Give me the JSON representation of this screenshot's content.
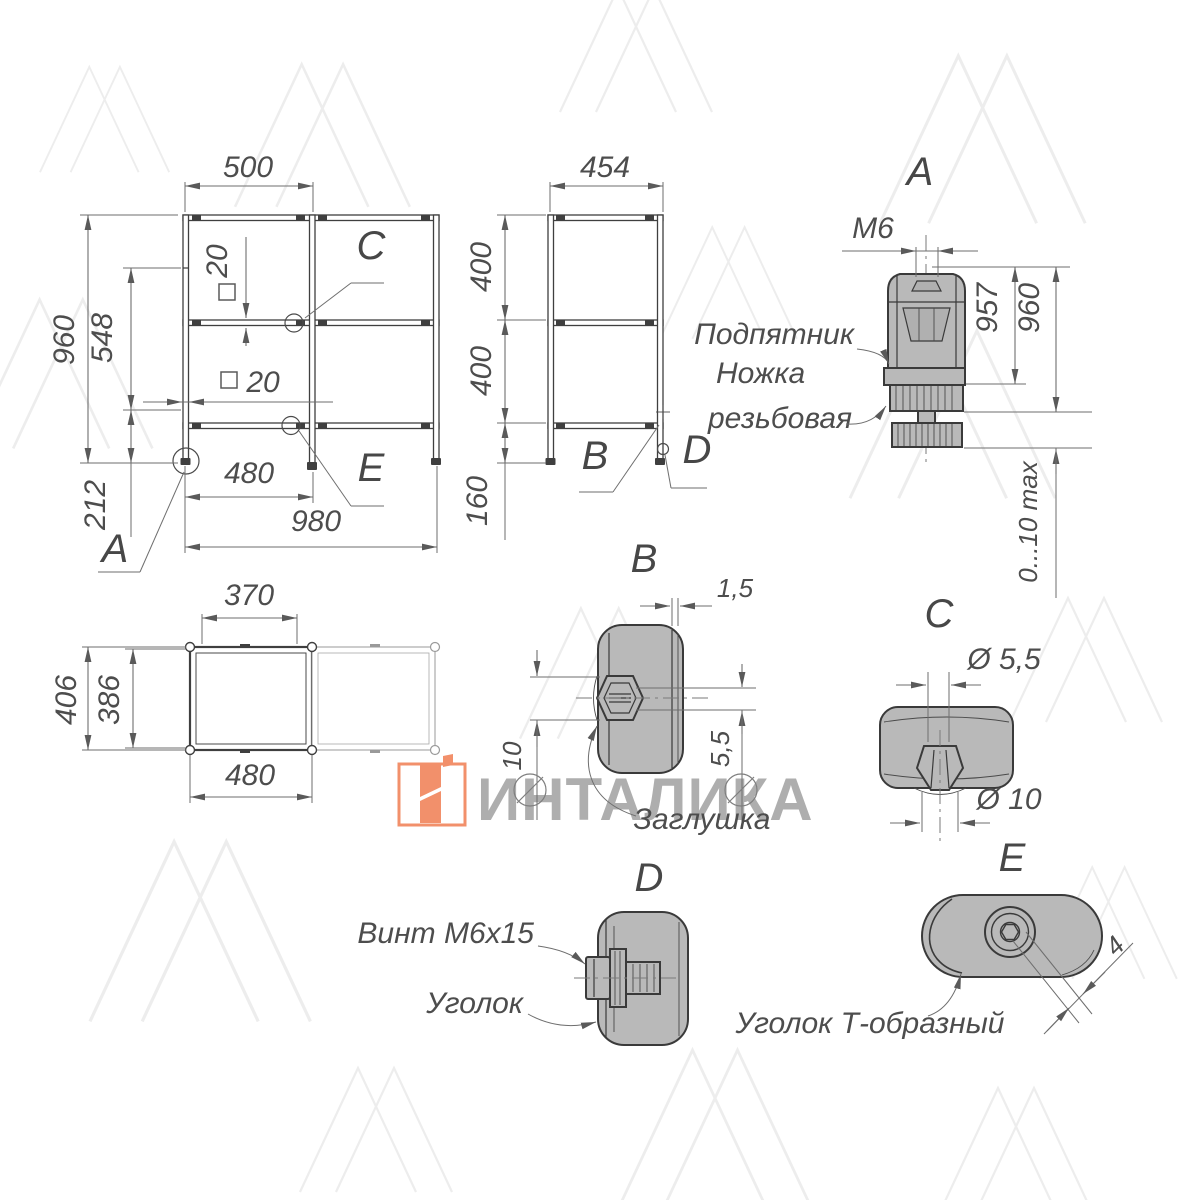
{
  "watermark": {
    "brand": "ИНТАЛИКА",
    "accent": "#F2906B",
    "text_color": "#aeaeae"
  },
  "front_view": {
    "dim_width_top": "500",
    "dim_height_total": "960",
    "dim_height_mid": "548",
    "dim_height_bottom": "212",
    "dim_tube_vertical": "20",
    "dim_tube_horizontal": "20",
    "dim_width_bay": "480",
    "dim_width_total": "980",
    "label_a": "A",
    "label_c": "C",
    "label_e": "E"
  },
  "side_view": {
    "dim_depth": "454",
    "dim_upper": "400",
    "dim_lower": "400",
    "dim_legs": "160",
    "label_b": "B",
    "label_d": "D"
  },
  "detail_a": {
    "title": "A",
    "dim_thread": "M6",
    "dim_957": "957",
    "dim_960": "960",
    "dim_range": "0...10 max",
    "callout_foot": "Подпятник",
    "callout_leg_1": "Ножка",
    "callout_leg_2": "резьбовая"
  },
  "top_view": {
    "dim_inner_width": "370",
    "dim_depth": "406",
    "dim_inner_depth": "386",
    "dim_width_bay": "480"
  },
  "detail_b": {
    "title": "B",
    "dim_wall": "1,5",
    "dim_plug": "10",
    "dim_slot": "5,5",
    "callout": "Заглушка"
  },
  "detail_c": {
    "title": "C",
    "dim_hole": "Ø 5,5",
    "dim_clip": "Ø 10"
  },
  "detail_d": {
    "title": "D",
    "callout_screw": "Винт М6х15",
    "callout_bracket": "Уголок"
  },
  "detail_e": {
    "title": "E",
    "dim_hex": "4",
    "callout": "Уголок Т-образный"
  }
}
